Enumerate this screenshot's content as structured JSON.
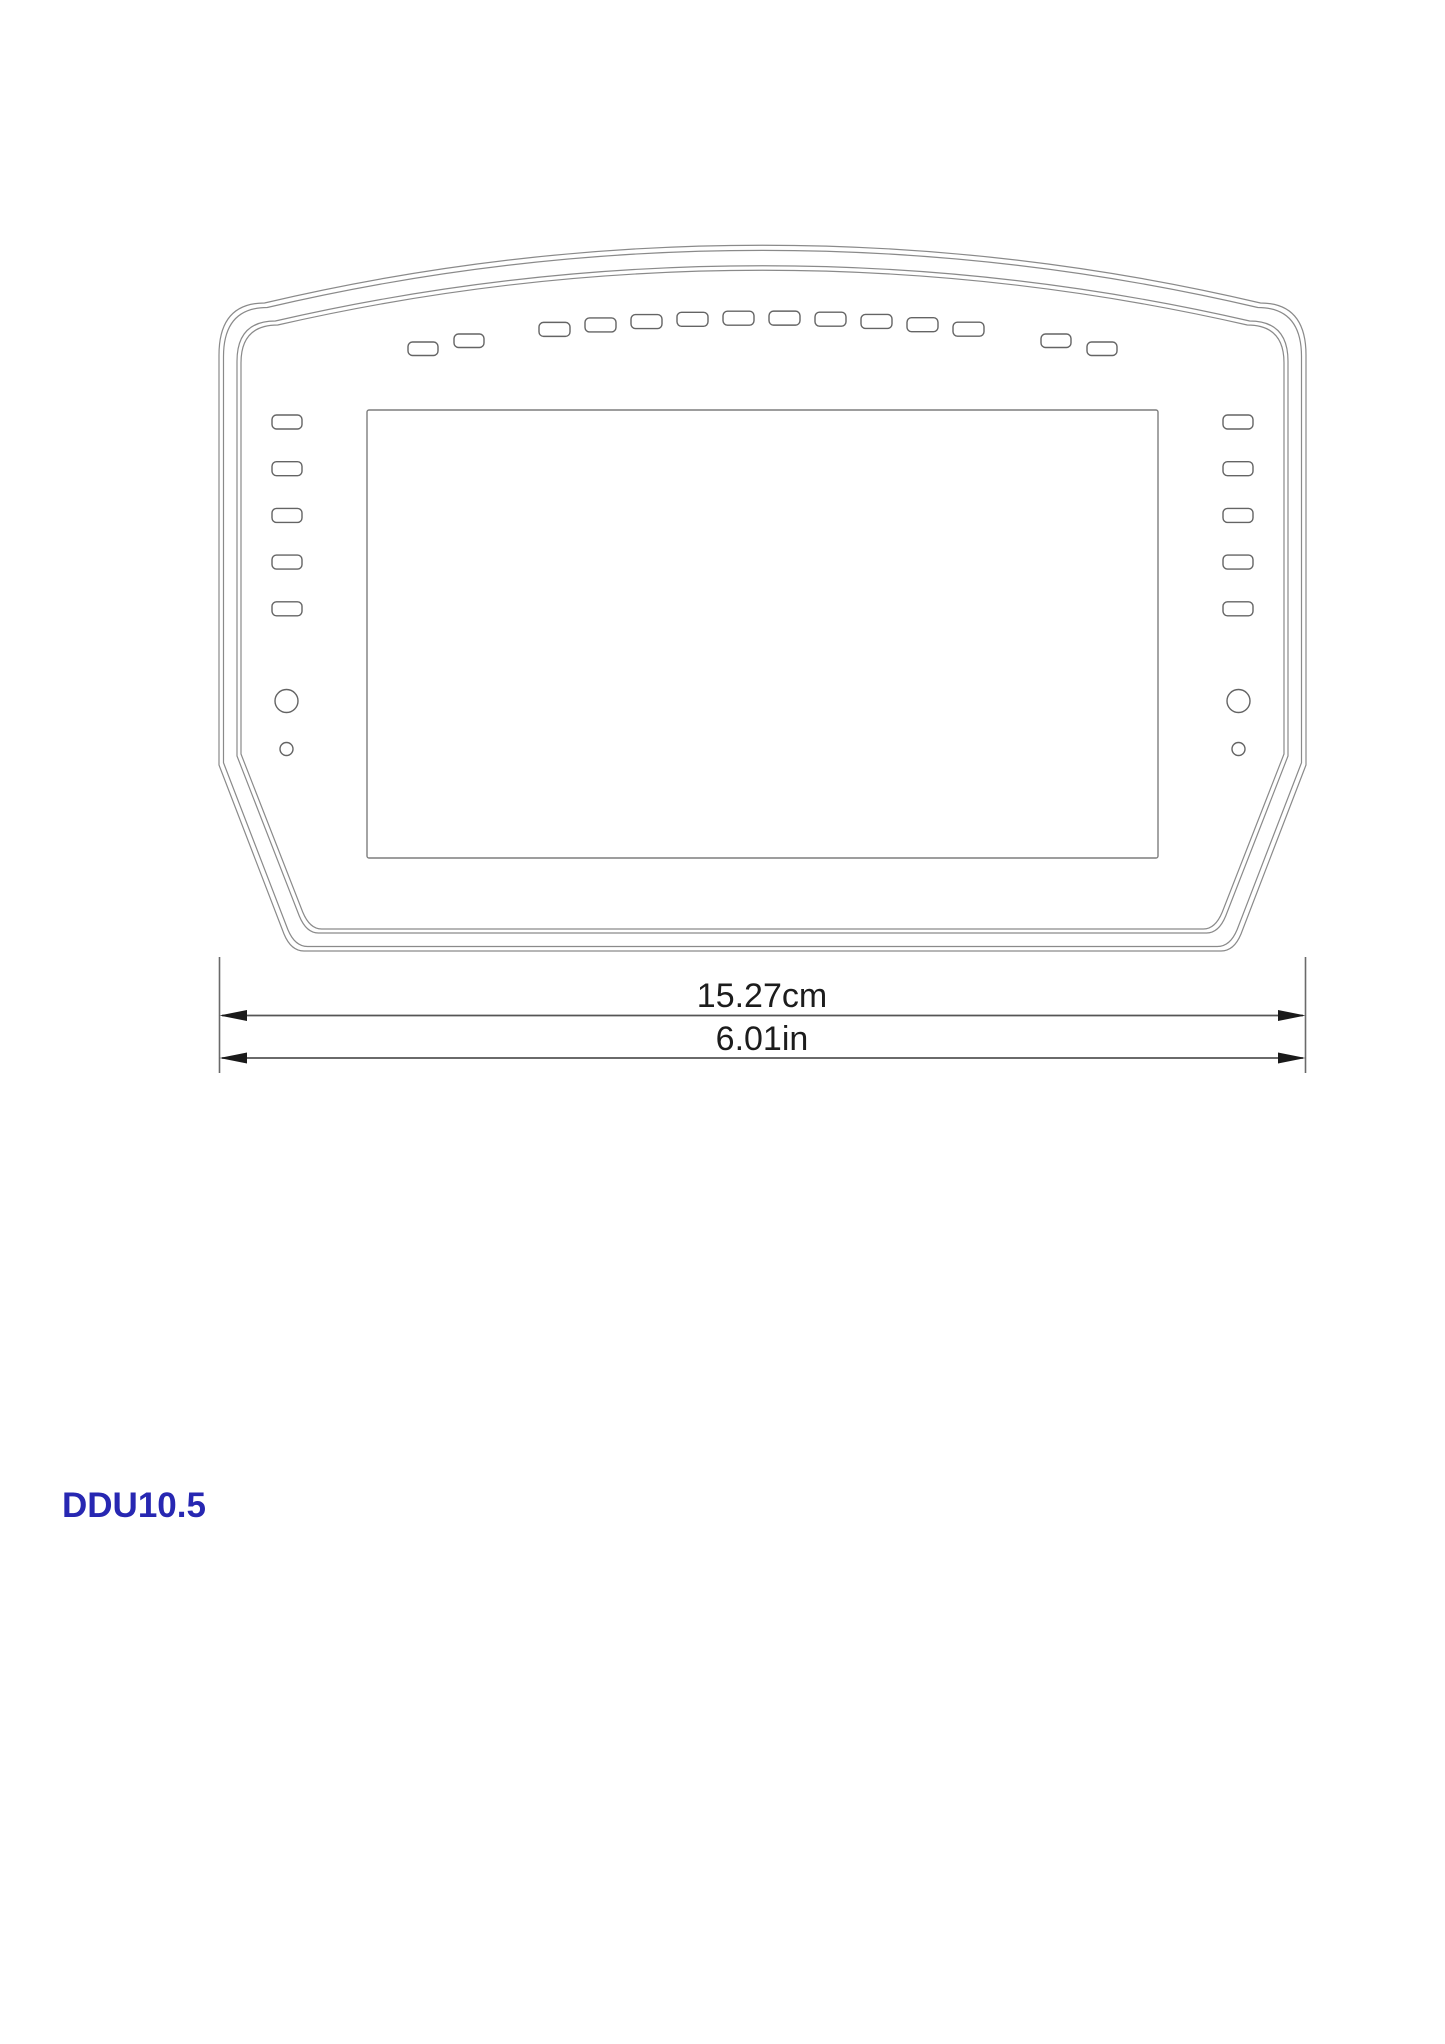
{
  "page": {
    "background": "#ffffff"
  },
  "drawing": {
    "product": {
      "label": "DDU10.5",
      "color": "#2727b2"
    },
    "dimensions": {
      "metric": "15.27cm",
      "imperial": "6.01in"
    },
    "colors": {
      "outline": "#8a8a8a",
      "detail": "#646464",
      "screen_stroke": "#7d7d7d",
      "dimension_line": "#555555",
      "arrow": "#1a1a1a",
      "text": "#1c1c1c"
    },
    "features": {
      "top_center_led_count": 10,
      "top_left_pair_count": 2,
      "top_right_pair_count": 2,
      "side_led_count_each": 5,
      "large_button_circles": 2,
      "small_button_circles": 2
    }
  }
}
